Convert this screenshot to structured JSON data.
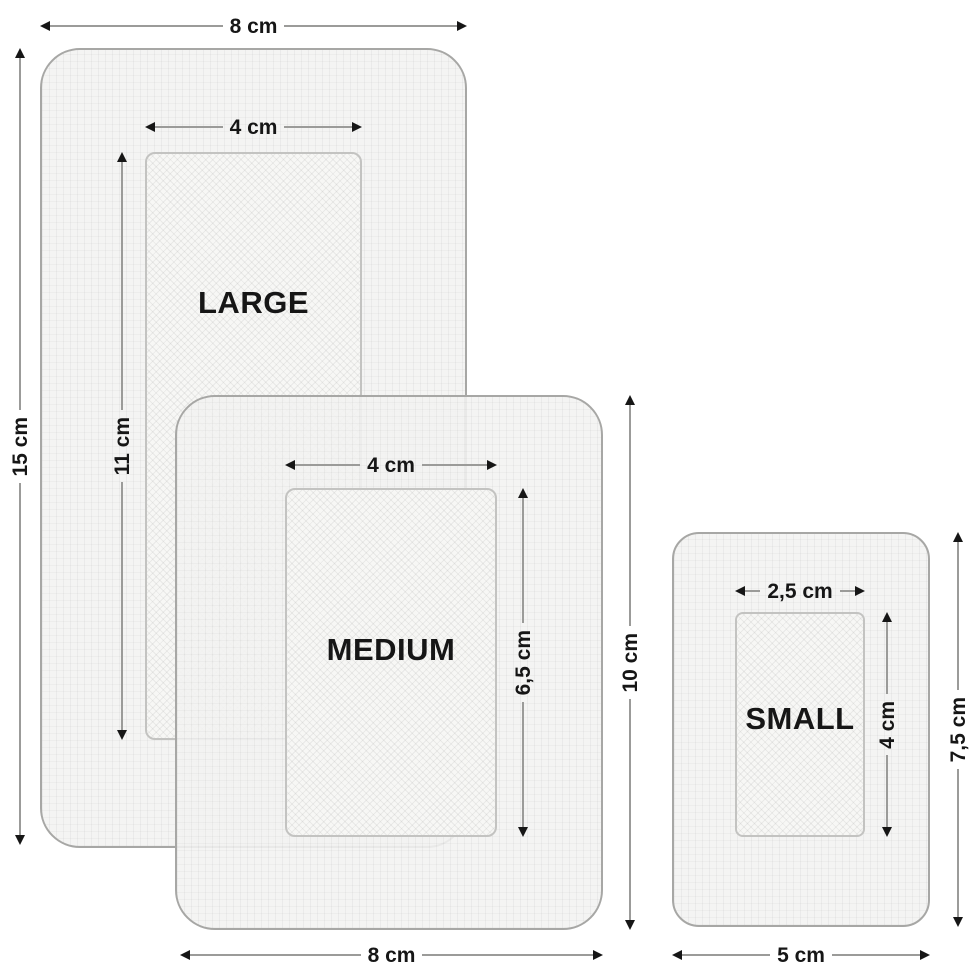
{
  "diagram": {
    "subject": "adhesive-plaster-sizes",
    "background": "#ffffff",
    "colors": {
      "plaster_fill": "#f3f3f1",
      "plaster_border": "#a7a7a5",
      "pad_fill": "#f7f7f5",
      "pad_border": "#c3c3c1",
      "dimension_line": "#9b9b99",
      "arrow": "#161616",
      "text": "#161616"
    },
    "plasters": [
      {
        "name": "LARGE",
        "outer_width_label": "8 cm",
        "outer_height_label": "15 cm",
        "pad_width_label": "4 cm",
        "pad_height_label": "11 cm",
        "outer_width_cm": 8,
        "outer_height_cm": 15,
        "pad_width_cm": 4,
        "pad_height_cm": 11
      },
      {
        "name": "MEDIUM",
        "outer_width_label": "8 cm",
        "outer_height_label": "10 cm",
        "pad_width_label": "4 cm",
        "pad_height_label": "6,5 cm",
        "outer_width_cm": 8,
        "outer_height_cm": 10,
        "pad_width_cm": 4,
        "pad_height_cm": 6.5
      },
      {
        "name": "SMALL",
        "outer_width_label": "5 cm",
        "outer_height_label": "7,5 cm",
        "pad_width_label": "2,5 cm",
        "pad_height_label": "4 cm",
        "outer_width_cm": 5,
        "outer_height_cm": 7.5,
        "pad_width_cm": 2.5,
        "pad_height_cm": 4
      }
    ]
  }
}
